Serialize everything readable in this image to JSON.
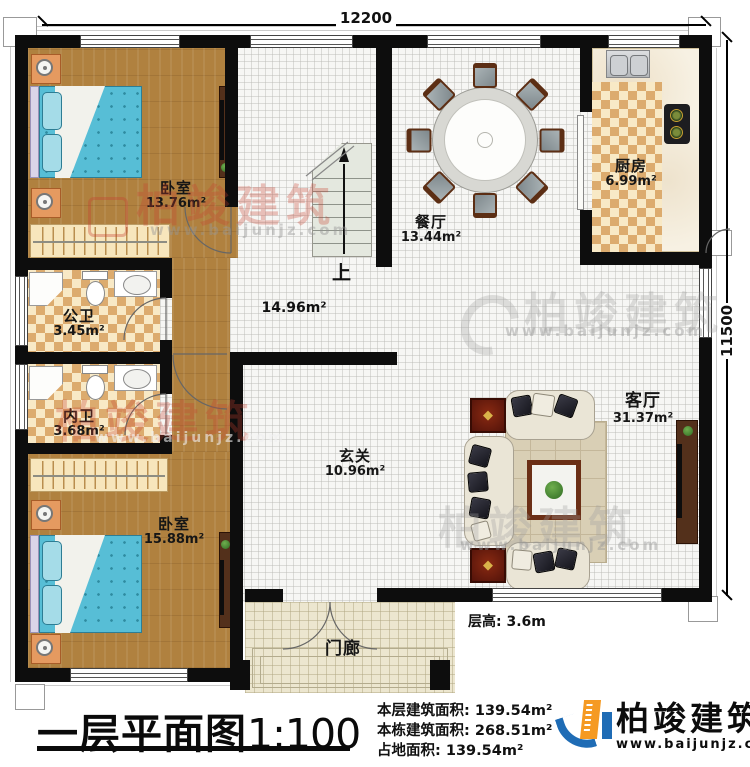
{
  "dimensions": {
    "width": "12200",
    "height": "11500"
  },
  "rooms": {
    "bedroom1": {
      "label": "卧室",
      "area": "13.76m²"
    },
    "public_bath": {
      "label": "公卫",
      "area": "3.45m²"
    },
    "private_bath": {
      "label": "内卫",
      "area": "3.68m²"
    },
    "bedroom2": {
      "label": "卧室",
      "area": "15.88m²"
    },
    "dining": {
      "label": "餐厅",
      "area": "13.44m²"
    },
    "kitchen": {
      "label": "厨房",
      "area": "6.99m²"
    },
    "hall": {
      "area": "14.96m²"
    },
    "foyer": {
      "label": "玄关",
      "area": "10.96m²"
    },
    "living": {
      "label": "客厅",
      "area": "31.37m²"
    },
    "porch": {
      "label": "门廊"
    }
  },
  "stairs": {
    "up_label": "上"
  },
  "floor_height": {
    "text": "层高: 3.6m"
  },
  "title_block": {
    "title": "一层平面图",
    "scale": "1:100",
    "stats": [
      {
        "label": "本层建筑面积:",
        "value": "139.54m²"
      },
      {
        "label": "本栋建筑面积:",
        "value": "268.51m²"
      },
      {
        "label": "占地面积:",
        "value": "139.54m²"
      }
    ],
    "brand": {
      "name": "柏竣建筑",
      "website": "www.baijunjz.com"
    }
  },
  "watermarks": {
    "brand": "柏竣建筑",
    "website": "www.baijunjz.com"
  },
  "colors": {
    "wall": "#0d0d0d",
    "wood_floor": "#b0813f",
    "tile_accent": "#dcab6e",
    "bed": "#57bed6",
    "brand_blue": "#1f6cb5",
    "brand_orange": "#f59a23"
  }
}
